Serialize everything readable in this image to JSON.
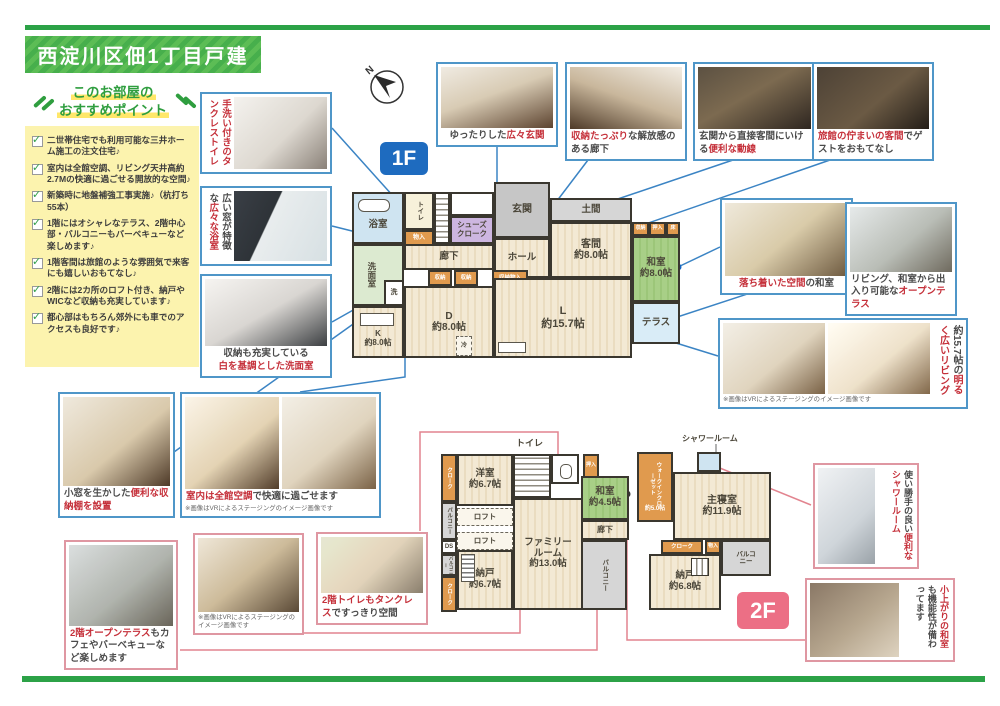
{
  "title": "西淀川区佃1丁目戸建",
  "recommend": {
    "header1": "このお部屋の",
    "header2": "おすすめポイント",
    "items": [
      "二世帯住宅でも利用可能な三井ホーム施工の注文住宅♪",
      "室内は全館空調、リビング天井高約2.7Mの快適に過ごせる開放的な空間♪",
      "新築時に地盤補強工事実施♪（杭打ち55本）",
      "1階にはオシャレなテラス、2階中心部・バルコニーもバーベキューなど楽しめます♪",
      "1階客間は旅館のような雰囲気で来客にも嬉しいおもてなし♪",
      "2階には2カ所のロフト付き、納戸やWICなど収納も充実しています♪",
      "都心部はもちろん郊外にも車でのアクセスも良好です♪"
    ]
  },
  "compass": {
    "label": "N"
  },
  "badges": {
    "floor1": "1F",
    "floor2": "2F"
  },
  "vr_note": "※画像はVRによるステージングのイメージ画像です",
  "colors": {
    "brand_green": "#2ca247",
    "photo_border_blue": "#4f96c8",
    "photo_border_pink": "#df97a2",
    "accent_red": "#c5303a",
    "badge_blue": "#1e6bbf",
    "badge_pink": "#ec6f85"
  },
  "photos": {
    "tankless_toilet": {
      "segs": [
        {
          "t": "手洗い付きの",
          "red": true
        },
        {
          "t": "タンクレストイレ",
          "red": true
        }
      ]
    },
    "bathroom": {
      "segs": [
        {
          "t": "広い窓が特徴な",
          "red": false
        },
        {
          "t": "広々な浴室",
          "red": true
        }
      ]
    },
    "senmen": {
      "segs": [
        {
          "t": "収納も充実している",
          "red": false
        },
        {
          "t": "白を基調とした洗面室",
          "red": true
        }
      ]
    },
    "genkan": {
      "segs": [
        {
          "t": "ゆったりした",
          "red": false
        },
        {
          "t": "広々玄関",
          "red": true
        }
      ]
    },
    "rouka": {
      "segs": [
        {
          "t": "収納たっぷり",
          "red": true
        },
        {
          "t": "な解放感のある廊下",
          "red": false
        }
      ]
    },
    "dousen": {
      "segs": [
        {
          "t": "玄関から直接客間にいける",
          "red": false
        },
        {
          "t": "便利な動線",
          "red": true
        }
      ]
    },
    "kyakuma": {
      "segs": [
        {
          "t": "旅館の佇まいの客間",
          "red": true
        },
        {
          "t": "でゲストをおもてなし",
          "red": false
        }
      ]
    },
    "washitsu": {
      "segs": [
        {
          "t": "落ち着いた空間",
          "red": true
        },
        {
          "t": "の和室",
          "red": false
        }
      ]
    },
    "open_terrace": {
      "segs": [
        {
          "t": "リビング、和室から出入り可能な",
          "red": false
        },
        {
          "t": "オープンテラス",
          "red": true
        }
      ]
    },
    "living": {
      "segs": [
        {
          "t": "約15.7帖の",
          "red": false
        },
        {
          "t": "明るく広いリビング",
          "red": true
        }
      ]
    },
    "shelf": {
      "segs": [
        {
          "t": "小窓を生かした",
          "red": false
        },
        {
          "t": "便利な収納棚を設置",
          "red": true
        }
      ]
    },
    "aircon": {
      "segs": [
        {
          "t": "室内は全館空調",
          "red": true
        },
        {
          "t": "で快適に過ごせます",
          "red": false
        }
      ]
    },
    "terrace2f": {
      "segs": [
        {
          "t": "2階オープンテラス",
          "red": true
        },
        {
          "t": "もカフェやバーベキューなど楽しめます",
          "red": false
        }
      ]
    },
    "toilet2f": {
      "segs": [
        {
          "t": "2階トイレもタンクレス",
          "red": true
        },
        {
          "t": "ですっきり空間",
          "red": false
        }
      ]
    },
    "shower": {
      "segs": [
        {
          "t": "使い勝手の良い",
          "red": false
        },
        {
          "t": "便利なシャワールーム",
          "red": true
        }
      ]
    },
    "koagari": {
      "segs": [
        {
          "t": "小上がりの和室",
          "red": true
        },
        {
          "t": "も機能性が備わってます",
          "red": false
        }
      ]
    }
  },
  "plan1f": {
    "rooms": {
      "bath": "浴室",
      "toilet": "トイレ",
      "monoire": "物入",
      "senmen": "洗面室",
      "sen": "洗",
      "shoes": "シューズクローク",
      "genkan": "玄関",
      "doma": "土間",
      "hall": "ホール",
      "rouka": "廊下",
      "kyakuma": "客間",
      "kyakuma_size": "約8.0帖",
      "shuno_a": "収納",
      "oshiire": "押入",
      "toko": "床",
      "washitsu": "和室",
      "washitsu_size": "約8.0帖",
      "terrace": "テラス",
      "shuno1": "収納",
      "shuno2": "収納",
      "shuno_monoire": "収納物入",
      "k": "K",
      "k_size": "約8.0帖",
      "d": "D",
      "d_size": "約8.0帖",
      "l": "L",
      "l_size": "約15.7帖",
      "rei": "冷"
    }
  },
  "plan2f": {
    "labels_out": {
      "toilet": "トイレ",
      "shower": "シャワールーム"
    },
    "rooms": {
      "cloak_tl": "クローク",
      "yoshitsu": "洋室",
      "yoshitsu_size": "約6.7帖",
      "balc1": "バルコニー",
      "ds": "DS",
      "balc2": "バルコニー",
      "cloak_l": "クローク",
      "loft1": "ロフト",
      "loft2": "ロフト",
      "nando1": "納戸",
      "nando1_size": "約6.7帖",
      "family": "ファミリールーム",
      "family_size": "約13.0帖",
      "oshiire": "押入",
      "washitsu": "和室",
      "washitsu_size": "約4.5帖",
      "wic": "ウォークインクローゼット",
      "wic_size": "約5.0帖",
      "shushin": "主寝室",
      "shushin_size": "約11.9帖",
      "rouka": "廊下",
      "balc_b": "バルコニー",
      "cloak_b": "クローク",
      "monoire": "物入",
      "nando2": "納戸",
      "nando2_size": "約6.8帖",
      "balc_r": "バルコニー"
    }
  }
}
